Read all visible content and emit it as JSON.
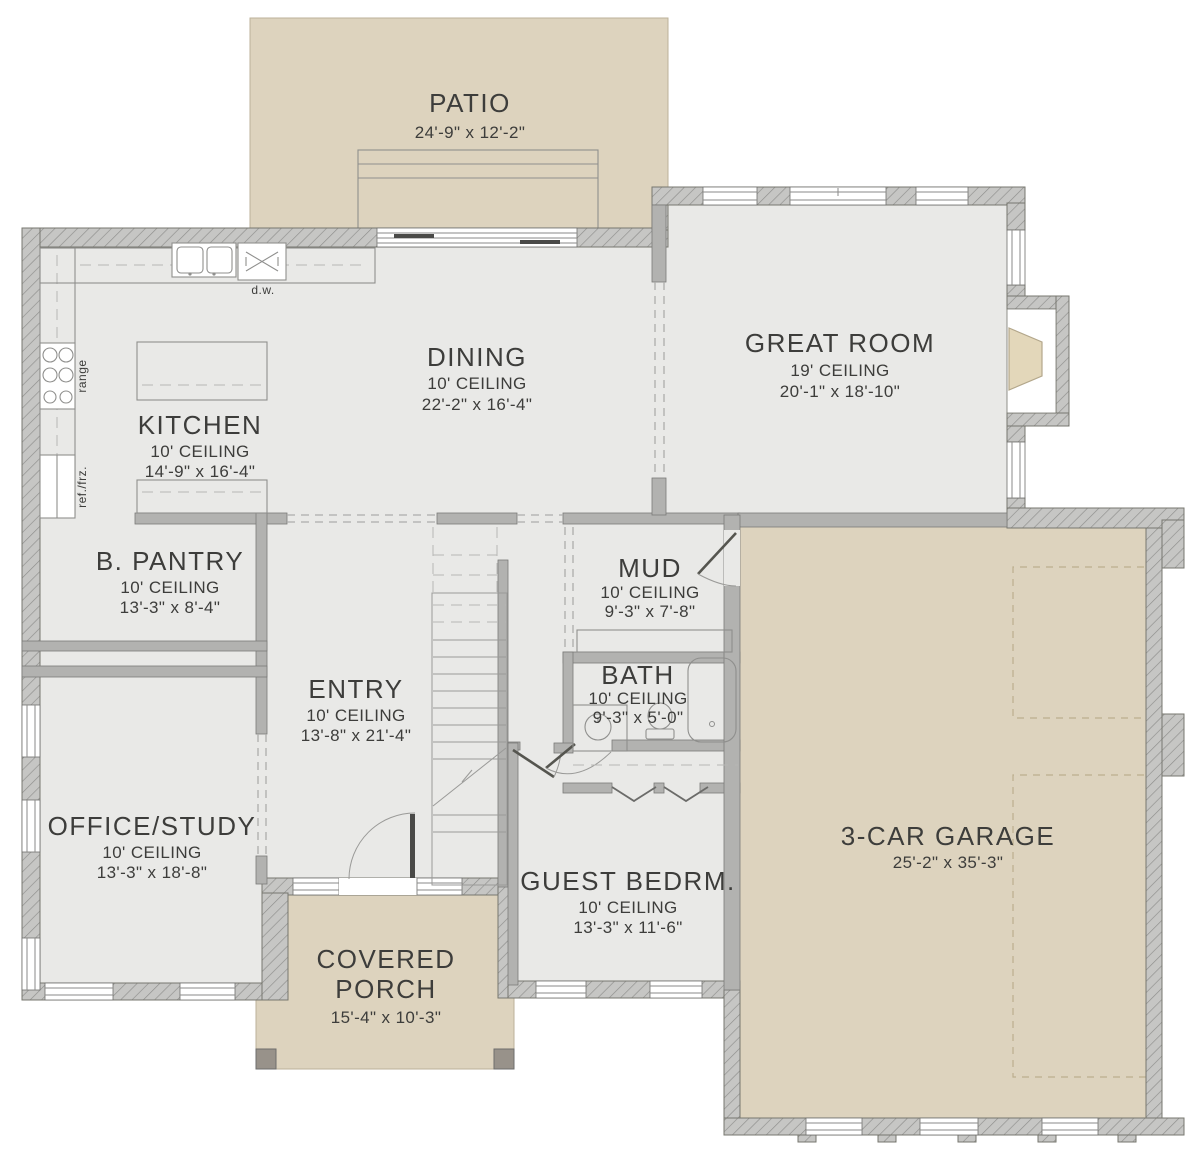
{
  "title": "First Floor Plan",
  "colors": {
    "floor": "#e9e9e7",
    "outdoor": "#ddd3be",
    "wall_gray": "#c6c6c4",
    "interior_wall": "#b2b2b0",
    "text": "#3d3d3b"
  },
  "rooms": {
    "patio": {
      "name": "PATIO",
      "dims": "24'-9\" x 12'-2\""
    },
    "great_room": {
      "name": "GREAT ROOM",
      "ceiling": "19' CEILING",
      "dims": "20'-1\" x 18'-10\""
    },
    "dining": {
      "name": "DINING",
      "ceiling": "10' CEILING",
      "dims": "22'-2\" x 16'-4\""
    },
    "kitchen": {
      "name": "KITCHEN",
      "ceiling": "10' CEILING",
      "dims": "14'-9\" x 16'-4\""
    },
    "pantry": {
      "name": "B. PANTRY",
      "ceiling": "10' CEILING",
      "dims": "13'-3\" x 8'-4\""
    },
    "mud": {
      "name": "MUD",
      "ceiling": "10' CEILING",
      "dims": "9'-3\" x 7'-8\""
    },
    "bath": {
      "name": "BATH",
      "ceiling": "10' CEILING",
      "dims": "9'-3\" x 5'-0\""
    },
    "entry": {
      "name": "ENTRY",
      "ceiling": "10' CEILING",
      "dims": "13'-8\" x 21'-4\""
    },
    "office": {
      "name": "OFFICE/STUDY",
      "ceiling": "10' CEILING",
      "dims": "13'-3\" x 18'-8\""
    },
    "guest": {
      "name": "GUEST BEDRM.",
      "ceiling": "10' CEILING",
      "dims": "13'-3\" x 11'-6\""
    },
    "porch": {
      "name_line1": "COVERED",
      "name_line2": "PORCH",
      "dims": "15'-4\" x 10'-3\""
    },
    "garage": {
      "name": "3-CAR GARAGE",
      "dims": "25'-2\" x 35'-3\""
    }
  },
  "fixtures": {
    "dishwasher": "d.w.",
    "range": "range",
    "fridge": "ref./frz."
  }
}
